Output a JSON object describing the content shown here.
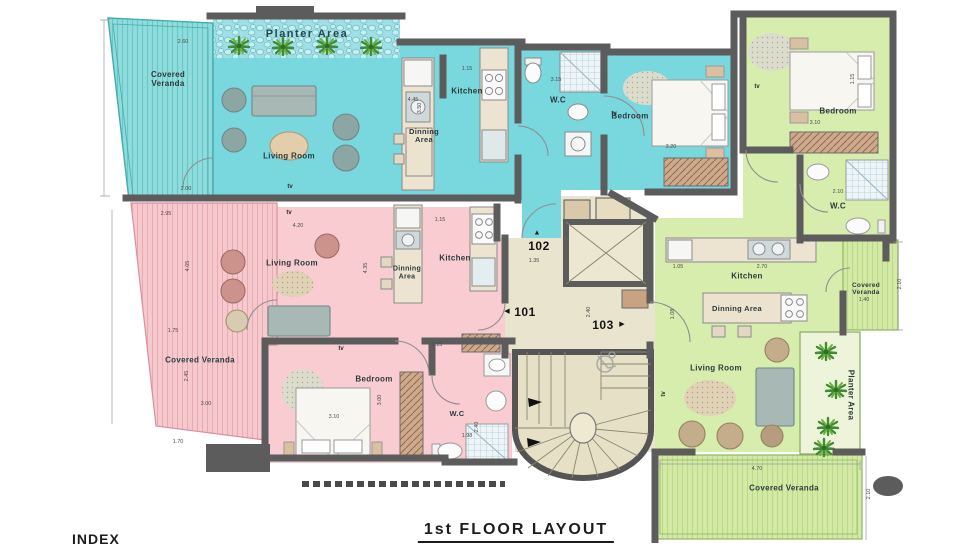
{
  "title": "1st FLOOR LAYOUT",
  "index_label": "INDEX",
  "tv_label": "tv",
  "arrows": {
    "up": "▲",
    "left": "◀",
    "right": "▶"
  },
  "units": {
    "blue": {
      "number": "102",
      "color": "#79d7de",
      "labels": {
        "planter": "Planter Area",
        "veranda": "Covered Veranda",
        "living": "Living Room",
        "dining": "Dinning Area",
        "kitchen": "Kitchen",
        "wc": "W.C",
        "bedroom": "Bedroom"
      }
    },
    "pink": {
      "number": "101",
      "color": "#f8ccd0",
      "labels": {
        "veranda": "Covered Veranda",
        "living": "Living Room",
        "dining": "Dinning Area",
        "kitchen": "Kitchen",
        "wc": "W.C",
        "bedroom": "Bedroom"
      }
    },
    "green": {
      "number": "103",
      "color": "#d7edae",
      "labels": {
        "planter": "Planter Area",
        "veranda_side": "Covered Veranda",
        "veranda_bottom": "Covered Veranda",
        "living": "Living Room",
        "dining": "Dinning Area",
        "kitchen": "Kitchen",
        "wc": "W.C",
        "bedroom": "Bedroom"
      }
    }
  },
  "core": {
    "door_101": "101",
    "door_102": "102",
    "door_103": "103"
  },
  "dimensions": [
    {
      "t": "2.60",
      "x": 183,
      "y": 42
    },
    {
      "t": "2.00",
      "x": 186,
      "y": 189
    },
    {
      "t": "4.45",
      "x": 413,
      "y": 100
    },
    {
      "t": "1.15",
      "x": 467,
      "y": 69
    },
    {
      "t": "3.50",
      "x": 420,
      "y": 108,
      "r": 1
    },
    {
      "t": "3.15",
      "x": 556,
      "y": 80
    },
    {
      "t": "3.20",
      "x": 671,
      "y": 147
    },
    {
      "t": "3.10",
      "x": 815,
      "y": 123
    },
    {
      "t": "1.15",
      "x": 853,
      "y": 79,
      "r": 1
    },
    {
      "t": "2.10",
      "x": 838,
      "y": 192
    },
    {
      "t": "1.05",
      "x": 678,
      "y": 267
    },
    {
      "t": "2.70",
      "x": 762,
      "y": 267
    },
    {
      "t": "1.40",
      "x": 864,
      "y": 300
    },
    {
      "t": "2.10",
      "x": 900,
      "y": 284,
      "r": 1
    },
    {
      "t": "4.70",
      "x": 757,
      "y": 469
    },
    {
      "t": "2.10",
      "x": 869,
      "y": 494,
      "r": 1
    },
    {
      "t": "1.08",
      "x": 673,
      "y": 314,
      "r": 1
    },
    {
      "t": "2.95",
      "x": 166,
      "y": 214
    },
    {
      "t": "4.20",
      "x": 298,
      "y": 226
    },
    {
      "t": "1.15",
      "x": 440,
      "y": 220
    },
    {
      "t": "4.05",
      "x": 188,
      "y": 266,
      "r": 1
    },
    {
      "t": "4.35",
      "x": 366,
      "y": 268,
      "r": 1
    },
    {
      "t": "1.75",
      "x": 173,
      "y": 331
    },
    {
      "t": "2.45",
      "x": 187,
      "y": 376,
      "r": 1
    },
    {
      "t": "3.00",
      "x": 206,
      "y": 404
    },
    {
      "t": "1.70",
      "x": 178,
      "y": 442
    },
    {
      "t": "3.10",
      "x": 334,
      "y": 417
    },
    {
      "t": "1.15",
      "x": 437,
      "y": 345
    },
    {
      "t": "1.98",
      "x": 467,
      "y": 436
    },
    {
      "t": "2.40",
      "x": 477,
      "y": 427,
      "r": 1
    },
    {
      "t": "1.35",
      "x": 534,
      "y": 261
    },
    {
      "t": "2.40",
      "x": 589,
      "y": 312,
      "r": 1
    },
    {
      "t": "3.00",
      "x": 380,
      "y": 400,
      "r": 1
    }
  ],
  "tv_markers": [
    {
      "x": 290,
      "y": 187
    },
    {
      "x": 614,
      "y": 114
    },
    {
      "x": 757,
      "y": 87
    },
    {
      "x": 289,
      "y": 213
    },
    {
      "x": 341,
      "y": 349
    },
    {
      "x": 664,
      "y": 394,
      "r": 1
    }
  ]
}
